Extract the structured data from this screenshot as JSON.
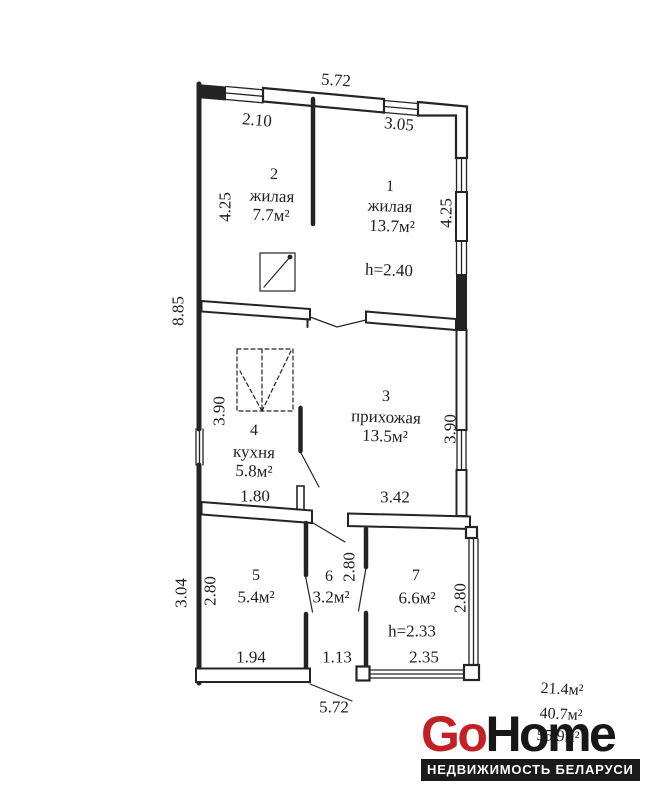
{
  "floorplan": {
    "rooms": [
      {
        "number": "1",
        "name": "жилая",
        "area": "13.7м²",
        "ceiling": "h=2.40"
      },
      {
        "number": "2",
        "name": "жилая",
        "area": "7.7м²"
      },
      {
        "number": "3",
        "name": "прихожая",
        "area": "13.5м²"
      },
      {
        "number": "4",
        "name": "кухня",
        "area": "5.8м²"
      },
      {
        "number": "5",
        "area": "5.4м²"
      },
      {
        "number": "6",
        "area": "3.2м²"
      },
      {
        "number": "7",
        "area": "6.6м²",
        "ceiling": "h=2.33"
      }
    ],
    "dimensions": {
      "top_overall": "5.72",
      "room2_width": "2.10",
      "room1_width": "3.05",
      "room2_depth": "4.25",
      "room1_depth": "4.25",
      "left_overall": "8.85",
      "kitchen_depth": "3.90",
      "hall_depth": "3.90",
      "kitchen_width": "1.80",
      "hall_width": "3.42",
      "annex_left": "3.04",
      "room5_depth": "2.80",
      "room5_width": "1.94",
      "room6_depth": "2.80",
      "room6_width": "1.13",
      "room7_depth": "2.80",
      "room7_width": "2.35",
      "bottom_overall": "5.72"
    },
    "areas_summary": [
      "21.4м²",
      "40.7м²",
      "55.9м²"
    ]
  },
  "logo": {
    "go": "Go",
    "home": "Home",
    "tagline": "НЕДВИЖИМОСТЬ БЕЛАРУСИ"
  },
  "colors": {
    "line": "#242424",
    "logo_red": "#c32026",
    "logo_black": "#171717",
    "tagline_bg": "#1a1a1a",
    "tagline_text": "#ffffff"
  }
}
